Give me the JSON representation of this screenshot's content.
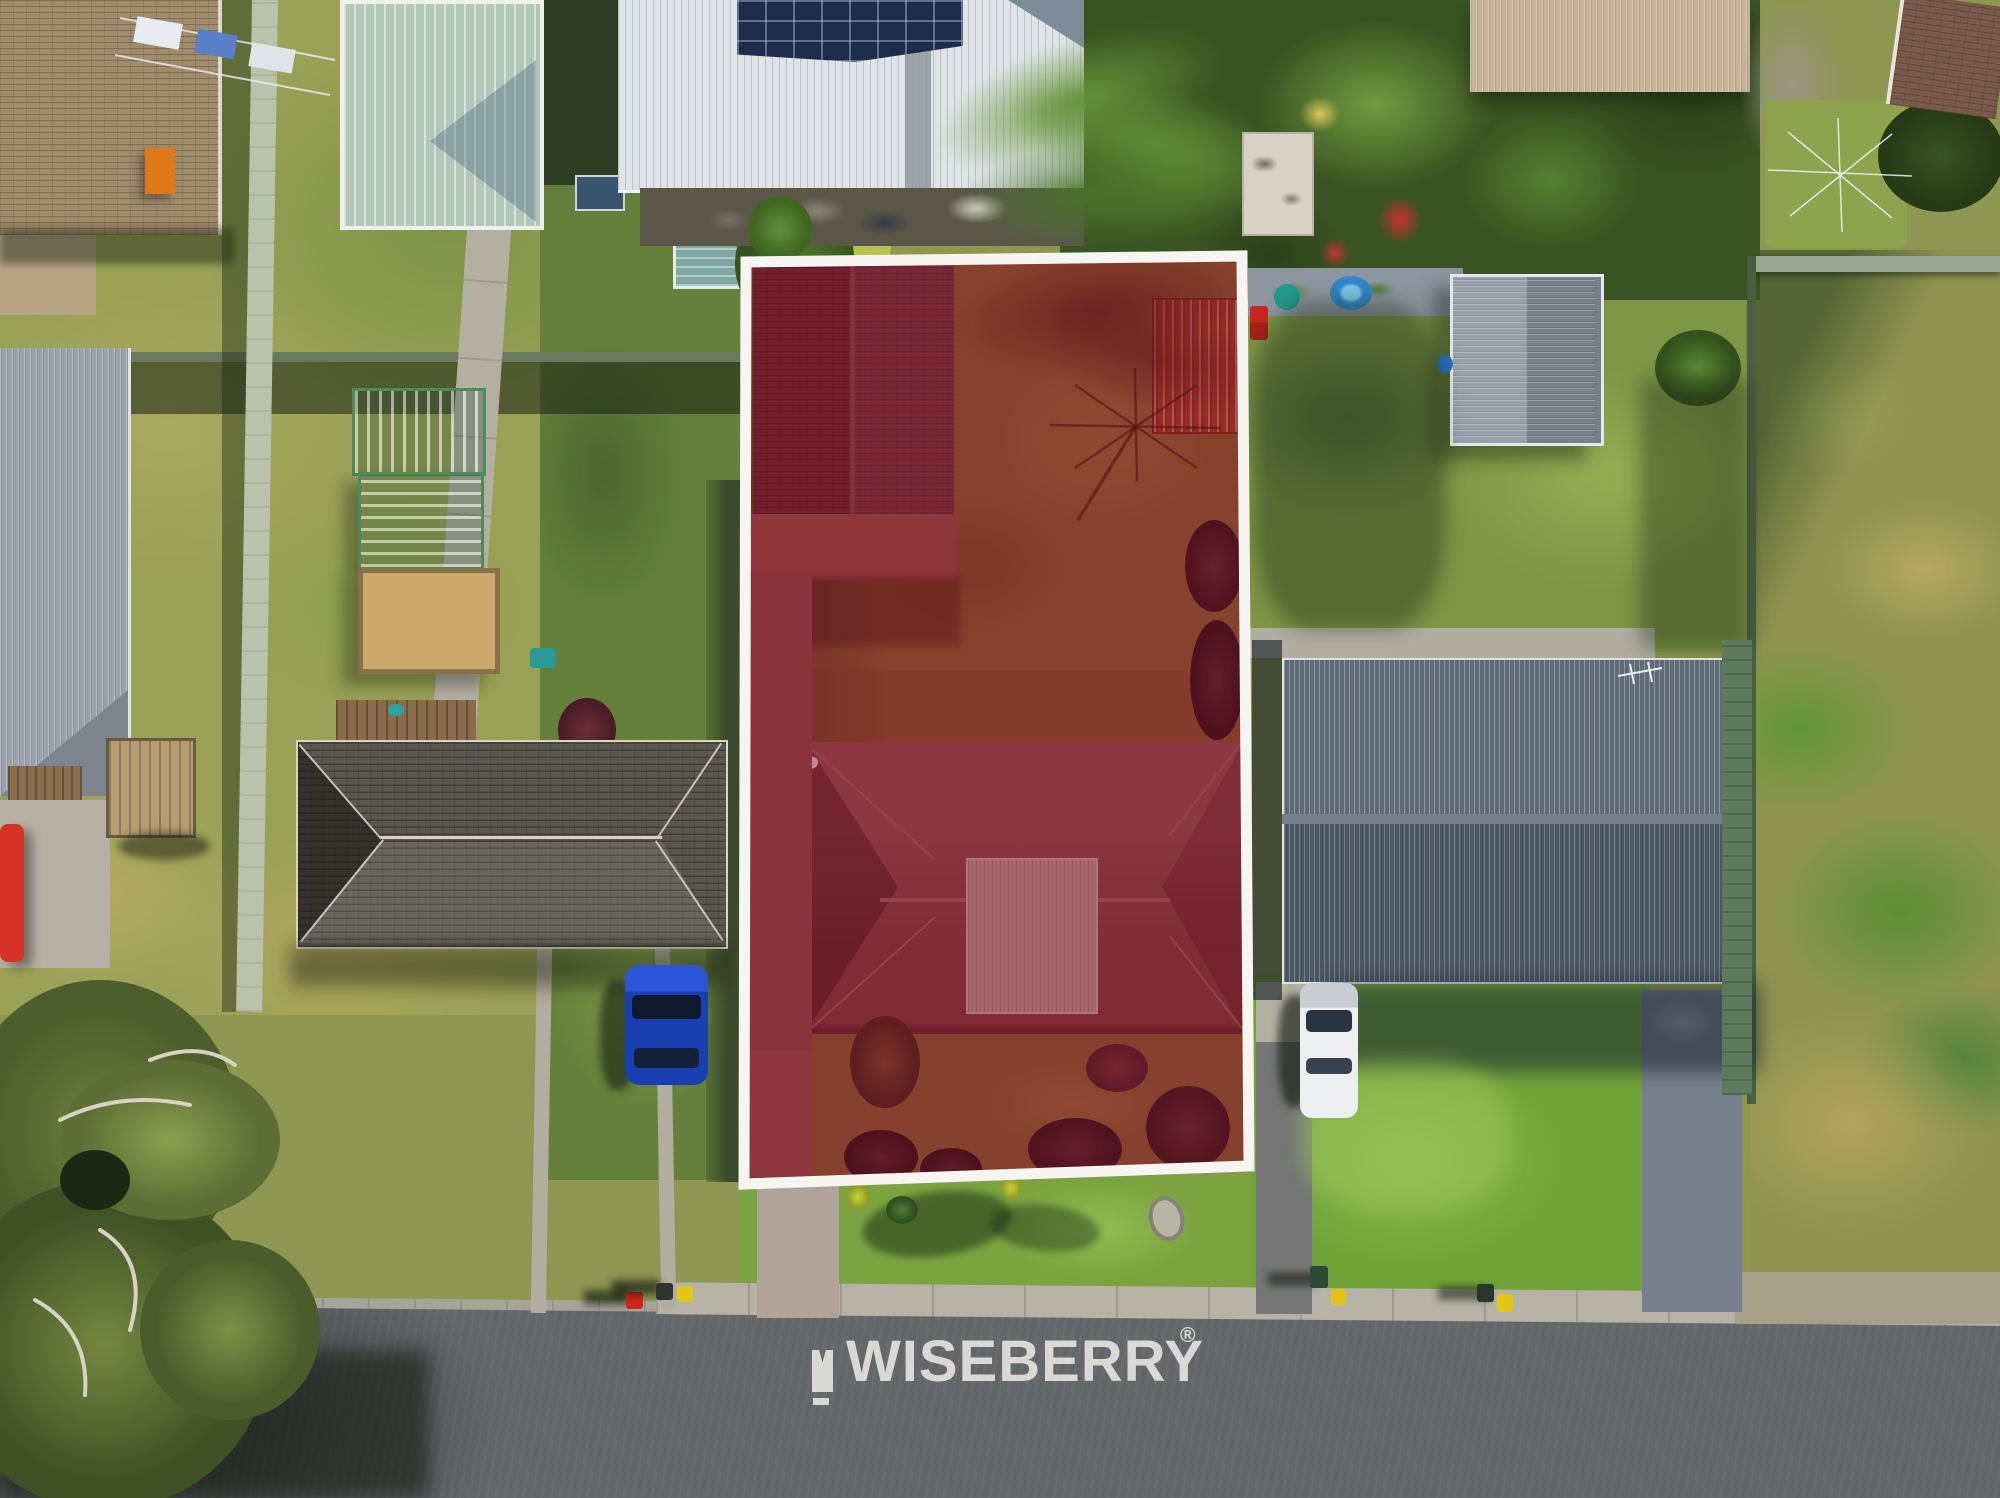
{
  "image": {
    "kind": "aerial-drone-photograph",
    "subject": "residential street block with one property lot highlighted for sale",
    "width_px": 2000,
    "height_px": 1498
  },
  "watermark": {
    "brand": "WISEBERRY",
    "registered_mark": "®",
    "logo_mark": "berry-flag-icon",
    "color": "#EFEDE8"
  },
  "highlight": {
    "name": "subject-lot-boundary",
    "border_color": "#FFFFFF",
    "overlay_color": "#7B1E30",
    "overlay_opacity": 0.32
  },
  "scene": {
    "street": "asphalt road across bottom with concrete kerb and footpath",
    "subject_lot_contents": [
      "garage-roof",
      "rotary-clothesline",
      "backyard-lawn",
      "red-shed-roof",
      "main-house-tiled-roof",
      "driveway",
      "front-lawn",
      "palm-tree",
      "shrubs"
    ],
    "neighbours": [
      "solar-panel-house-top",
      "pale-green-shed",
      "dark-grey-tile-roof-house-left",
      "blue-gray-metal-roof-house-right",
      "vacant-overgrown-lot-far-right",
      "brown-roof-house-top-left"
    ],
    "vehicles": [
      "blue-car-left-driveway",
      "white-car-right-driveway",
      "red-car-far-left"
    ],
    "bins": [
      "red-bin",
      "yellow-bin",
      "dark-green-bin"
    ],
    "colors": {
      "grass_bright": "#74A438",
      "grass_olive": "#99A156",
      "grass_dry": "#B3AA64",
      "road_asphalt": "#64676A",
      "concrete": "#B6B2A5",
      "right_roof": "#4B5663",
      "left_roof": "#5A574F",
      "lot_tint_roof": "#8C3C42"
    }
  }
}
